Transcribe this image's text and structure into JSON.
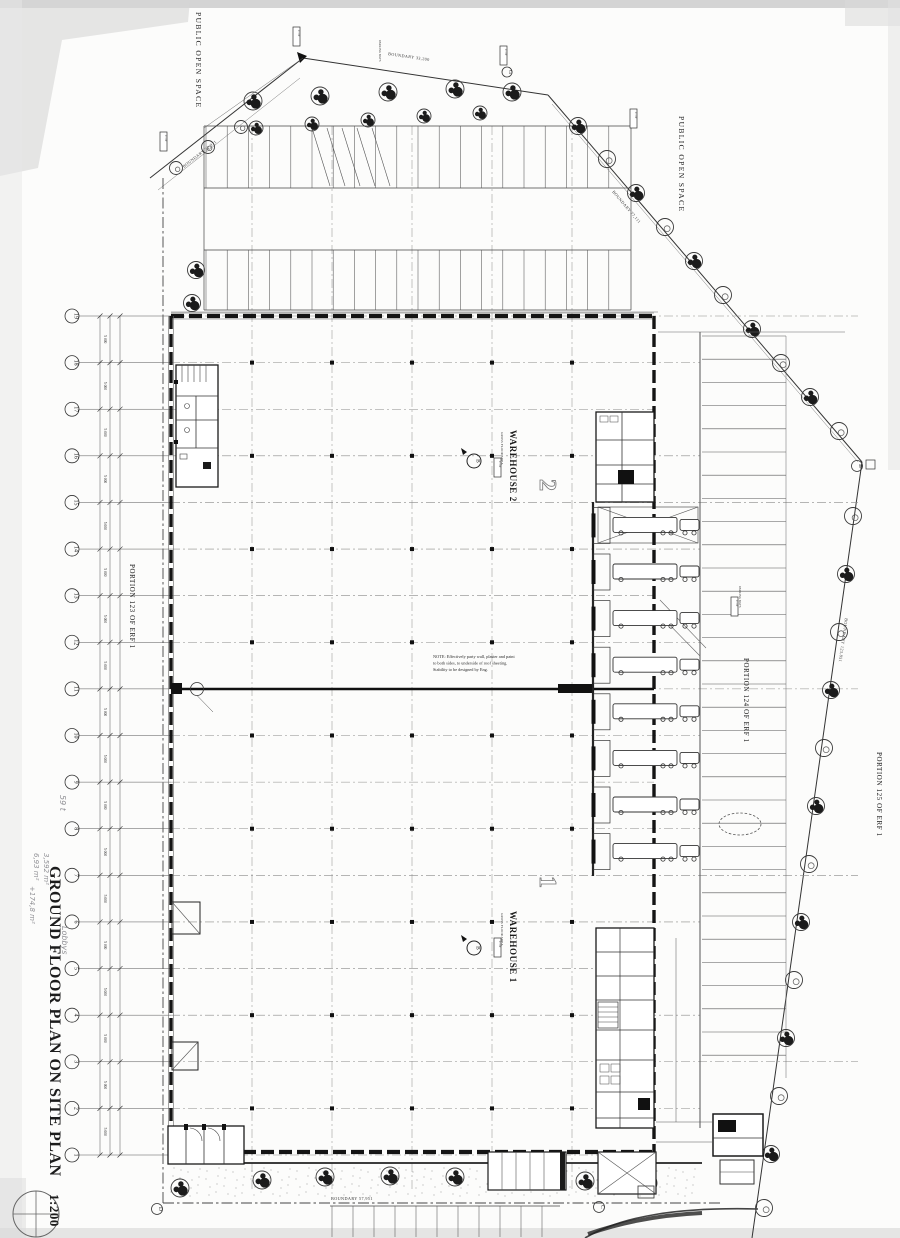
{
  "title": {
    "main": "GROUND FLOOR PLAN ON SITE PLAN",
    "scale": "1:200"
  },
  "areas": {
    "public_open_space_top": "PUBLIC OPEN SPACE",
    "public_open_space_right": "PUBLIC OPEN SPACE",
    "portion_123": "PORTION 123 OF ERF 1",
    "portion_124": "PORTION 124 OF ERF 1",
    "portion_125": "PORTION 125 OF ERF 1"
  },
  "buildings": {
    "warehouse_2": {
      "label": "WAREHOUSE 2",
      "number": "2",
      "sub": "GROSS FLOOR AREA"
    },
    "warehouse_1": {
      "label": "WAREHOUSE 1",
      "number": "1",
      "sub": "GROSS FLOOR AREA"
    }
  },
  "boundaries": {
    "top_left": "BOUNDARY 32,971",
    "top": "BOUNDARY 33,200",
    "top_right": "BOUNDARY 77,111",
    "right": "BOUNDARY 123,851",
    "bottom": "BOUNDARY 57,951"
  },
  "note": {
    "line1": "NOTE: Effectively party wall, plaster and paint",
    "line2": "to both sides, to underside of roof sheeting.",
    "line3": "Stability to be designed by Eng."
  },
  "grid": {
    "numbers": [
      "1",
      "2",
      "3",
      "4",
      "5",
      "6",
      "7",
      "8",
      "9",
      "10",
      "11",
      "12",
      "13",
      "14",
      "15",
      "16",
      "17",
      "18",
      "19"
    ]
  },
  "dimensions": {
    "bay": "5 000"
  },
  "section_marker": "B",
  "reference_letters": {
    "d": "D",
    "c": "C",
    "g": "G",
    "b": "B"
  },
  "small_tags": {
    "level": "17.19",
    "parking_note": "PARKING BAYS"
  },
  "annotations_handwritten": {
    "area1": "6,93 m²",
    "area2": "3,592 m²",
    "area3": "+174,8 m²",
    "lobbys": "Lobbys",
    "misc": "59 t"
  }
}
